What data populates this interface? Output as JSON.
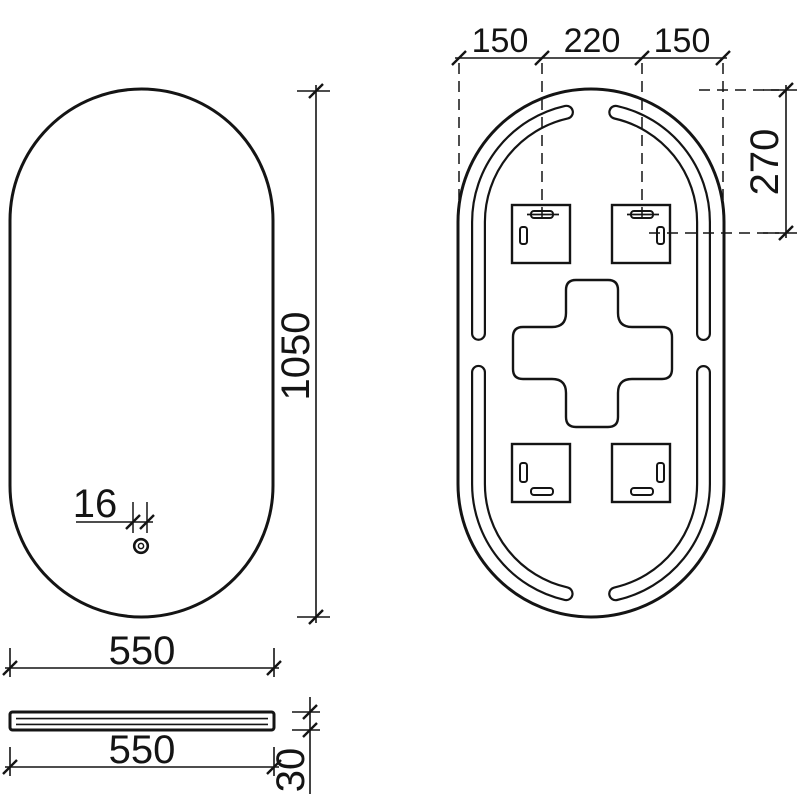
{
  "drawing": {
    "background_color": "#ffffff",
    "line_color": "#141414",
    "views": {
      "front": {
        "dimensions": {
          "height": "1050",
          "width": "550",
          "sensor_diameter": "16"
        },
        "icons": {
          "touch_sensor": "touch-sensor-icon"
        }
      },
      "back": {
        "dimensions": {
          "mount_span_left": "150",
          "mount_span_center": "220",
          "mount_span_right": "150",
          "mount_offset_top": "270"
        }
      },
      "side": {
        "dimensions": {
          "width": "550",
          "thickness": "30"
        }
      }
    }
  }
}
